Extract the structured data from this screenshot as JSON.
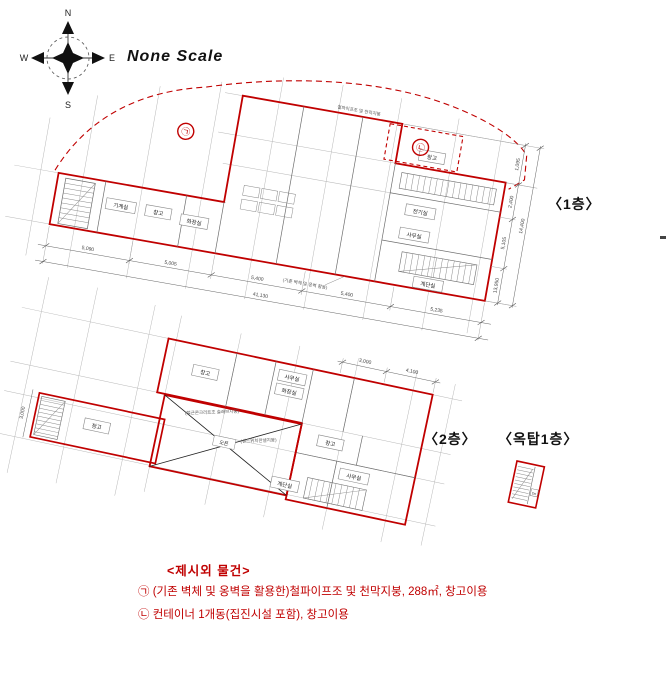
{
  "header": {
    "scale_label": "None Scale"
  },
  "compass": {
    "n": "N",
    "s": "S",
    "e": "E",
    "w": "W"
  },
  "floor1": {
    "title": "〈1층〉",
    "marker_a": "㉠",
    "marker_b": "㉡",
    "rooms": [
      "기계실",
      "창고",
      "화장실",
      "창고",
      "전기실",
      "사무실",
      "계단실"
    ],
    "note_top": "철파이프조 및 천막지붕",
    "note_bottom": "(기존 벽체 및 옹벽 활용)",
    "dims_bottom": [
      "5,090",
      "5,005",
      "5,400",
      "5,400",
      "5,235"
    ],
    "dim_total": "41,130",
    "dims_right": [
      "1,095",
      "2,400",
      "5,105",
      "13,950"
    ],
    "dim_right_total": "14,400"
  },
  "floor2": {
    "title": "〈2층〉",
    "rooms": [
      "창고",
      "창고",
      "사무실",
      "화장실",
      "창고",
      "사무실",
      "계단실"
    ],
    "void_label": "오픈",
    "note_1": "(철근콘크리트조 슬래브지붕)",
    "note_2": "(샌드위치판넬지붕)",
    "dims_top": [
      "3,000",
      "4,100"
    ],
    "dim_left": "3,000"
  },
  "rooftop": {
    "title": "〈옥탑1층〉",
    "stair_label": "Dn"
  },
  "notes": {
    "title": "<제시외 물건>",
    "line1": "㉠ (기존 벽체 및 옹벽을 활용한)철파이프조 및 천막지붕, 288㎡, 창고이용",
    "line2": "㉡ 컨테이너 1개동(집진시설 포함), 창고이용"
  },
  "colors": {
    "red": "#c00000",
    "grid": "#b8b8b8",
    "wall": "#6e6e6e"
  }
}
